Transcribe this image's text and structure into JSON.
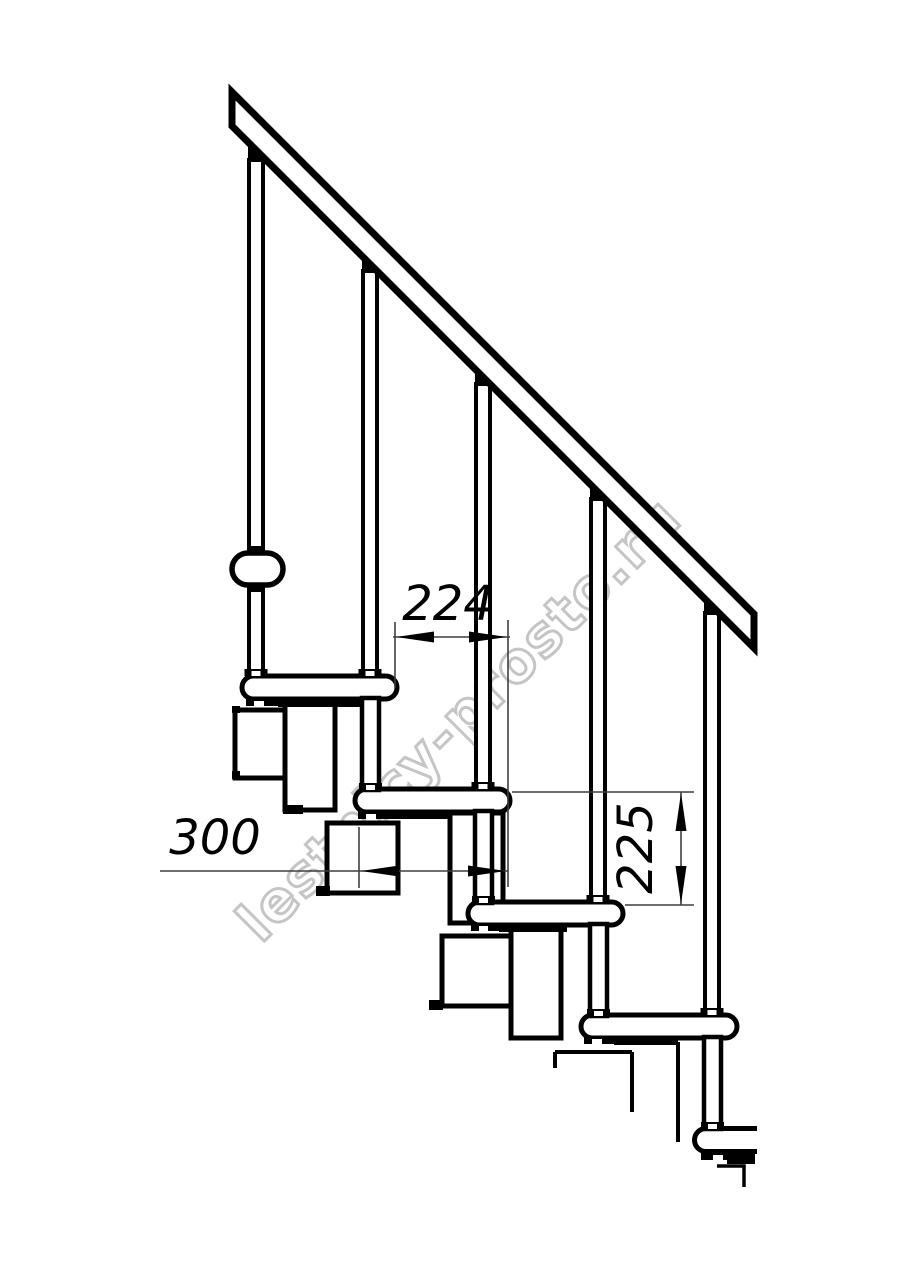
{
  "drawing": {
    "watermark": {
      "text": "lestnicy-prosto.ru"
    },
    "dimensions": {
      "step_run": {
        "value": "224"
      },
      "tread_depth": {
        "value": "300"
      },
      "step_rise": {
        "value": "225"
      }
    },
    "colors": {
      "line": "#000000",
      "dimension_line": "#3f3f3f",
      "watermark_outline": "#c5c5c5",
      "background": "#ffffff"
    }
  }
}
